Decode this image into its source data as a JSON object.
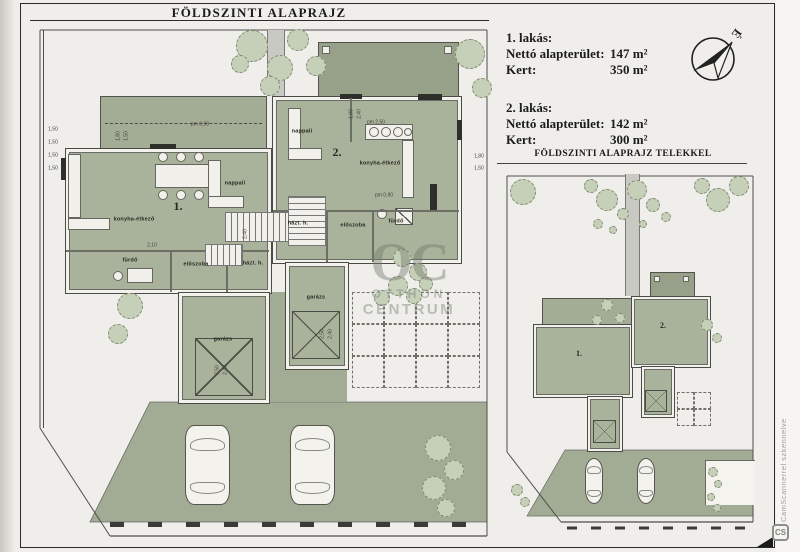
{
  "titles": {
    "main": "FÖLDSZINTI ALAPRAJZ",
    "site": "FÖLDSZINTI ALAPRAJZ TELEKKEL"
  },
  "info": {
    "apartments": [
      {
        "name": "1. lakás:",
        "rows": [
          [
            "Nettó alapterület:",
            "147 m²"
          ],
          [
            "Kert:",
            "350 m²"
          ]
        ]
      },
      {
        "name": "2. lakás:",
        "rows": [
          [
            "Nettó alapterület:",
            "142 m²"
          ],
          [
            "Kert:",
            "300 m²"
          ]
        ]
      }
    ]
  },
  "compass": {
    "north_label": "É"
  },
  "watermarks": {
    "oc_logo": "OC",
    "oc_line1": "OTTHON",
    "oc_line2": "CENTRUM",
    "scanner_text": "CamScannerrel szkennelve",
    "scanner_logo": "CS"
  },
  "colors": {
    "room_green": "#a9b29a",
    "terrace_gray": "#97a189",
    "tree_fill": "#c6cfb8",
    "paper": "#efeeea",
    "frame_line": "#2b2b28"
  },
  "floor_plan": {
    "labels": [
      {
        "text": "1.",
        "x": 148,
        "y": 182,
        "cls": "unit"
      },
      {
        "text": "2.",
        "x": 307,
        "y": 128,
        "cls": "unit"
      },
      {
        "text": "nappali",
        "x": 205,
        "y": 160,
        "cls": "room"
      },
      {
        "text": "konyha-étkező",
        "x": 104,
        "y": 196,
        "cls": "room"
      },
      {
        "text": "fürdő",
        "x": 100,
        "y": 237,
        "cls": "room"
      },
      {
        "text": "előszoba",
        "x": 166,
        "y": 241,
        "cls": "room"
      },
      {
        "text": "házt. h.",
        "x": 223,
        "y": 240,
        "cls": "room"
      },
      {
        "text": "garázs",
        "x": 193,
        "y": 316,
        "cls": "room"
      },
      {
        "text": "nappali",
        "x": 272,
        "y": 108,
        "cls": "room"
      },
      {
        "text": "konyha-étkező",
        "x": 350,
        "y": 140,
        "cls": "room"
      },
      {
        "text": "házt. h.",
        "x": 268,
        "y": 200,
        "cls": "room"
      },
      {
        "text": "előszoba",
        "x": 323,
        "y": 202,
        "cls": "room"
      },
      {
        "text": "fürdő",
        "x": 366,
        "y": 198,
        "cls": "room"
      },
      {
        "text": "garázs",
        "x": 286,
        "y": 274,
        "cls": "room"
      },
      {
        "text": "1,50",
        "x": 23,
        "y": 106,
        "cls": "dim"
      },
      {
        "text": "1,50",
        "x": 23,
        "y": 119,
        "cls": "dim"
      },
      {
        "text": "1,50",
        "x": 23,
        "y": 132,
        "cls": "dim"
      },
      {
        "text": "1,50",
        "x": 23,
        "y": 145,
        "cls": "dim"
      },
      {
        "text": "1,80",
        "x": 89,
        "y": 112,
        "cls": "dim",
        "rot": -90
      },
      {
        "text": "1,50",
        "x": 97,
        "y": 112,
        "cls": "dim",
        "rot": -90
      },
      {
        "text": "pm 0,90",
        "x": 170,
        "y": 101,
        "cls": "dim"
      },
      {
        "text": "pm 2,50",
        "x": 346,
        "y": 99,
        "cls": "dim"
      },
      {
        "text": "1,80",
        "x": 322,
        "y": 90,
        "cls": "dim",
        "rot": -90
      },
      {
        "text": "2,40",
        "x": 330,
        "y": 90,
        "cls": "dim",
        "rot": -90
      },
      {
        "text": "1,80",
        "x": 449,
        "y": 133,
        "cls": "dim"
      },
      {
        "text": "1,50",
        "x": 449,
        "y": 145,
        "cls": "dim"
      },
      {
        "text": "2,10",
        "x": 122,
        "y": 222,
        "cls": "dim"
      },
      {
        "text": "2,40",
        "x": 216,
        "y": 210,
        "cls": "dim",
        "rot": -90
      },
      {
        "text": "pm 0,90",
        "x": 354,
        "y": 172,
        "cls": "dim"
      },
      {
        "text": "2,50",
        "x": 293,
        "y": 310,
        "cls": "dim",
        "rot": -90
      },
      {
        "text": "2,40",
        "x": 301,
        "y": 310,
        "cls": "dim",
        "rot": -90
      },
      {
        "text": "2,50",
        "x": 188,
        "y": 346,
        "cls": "dim",
        "rot": -90
      },
      {
        "text": "2,40",
        "x": 196,
        "y": 346,
        "cls": "dim",
        "rot": -90
      }
    ],
    "trees": [
      {
        "x": 222,
        "y": 22,
        "r": 16
      },
      {
        "x": 250,
        "y": 44,
        "r": 13
      },
      {
        "x": 268,
        "y": 16,
        "r": 11
      },
      {
        "x": 286,
        "y": 42,
        "r": 10
      },
      {
        "x": 240,
        "y": 62,
        "r": 10
      },
      {
        "x": 210,
        "y": 40,
        "r": 9
      },
      {
        "x": 440,
        "y": 30,
        "r": 15
      },
      {
        "x": 452,
        "y": 64,
        "r": 10
      },
      {
        "x": 100,
        "y": 282,
        "r": 13
      },
      {
        "x": 88,
        "y": 310,
        "r": 10
      },
      {
        "x": 372,
        "y": 234,
        "r": 9
      },
      {
        "x": 388,
        "y": 248,
        "r": 9
      },
      {
        "x": 368,
        "y": 262,
        "r": 10
      },
      {
        "x": 352,
        "y": 274,
        "r": 8
      },
      {
        "x": 384,
        "y": 272,
        "r": 8
      },
      {
        "x": 396,
        "y": 260,
        "r": 7
      },
      {
        "x": 408,
        "y": 424,
        "r": 13
      },
      {
        "x": 424,
        "y": 446,
        "r": 10
      },
      {
        "x": 404,
        "y": 464,
        "r": 12
      },
      {
        "x": 416,
        "y": 484,
        "r": 9
      }
    ],
    "paving": [
      {
        "x": 322,
        "y": 268,
        "cols": 4,
        "rows": 3,
        "cell": 32
      }
    ],
    "furniture": [
      {
        "t": "rect",
        "x": 292,
        "y": 22,
        "w": 8,
        "h": 8
      },
      {
        "t": "rect",
        "x": 414,
        "y": 22,
        "w": 8,
        "h": 8
      },
      {
        "t": "rect",
        "x": 125,
        "y": 140,
        "w": 58,
        "h": 24
      },
      {
        "t": "circ",
        "x": 133,
        "y": 133,
        "r": 5
      },
      {
        "t": "circ",
        "x": 151,
        "y": 133,
        "r": 5
      },
      {
        "t": "circ",
        "x": 169,
        "y": 133,
        "r": 5
      },
      {
        "t": "circ",
        "x": 133,
        "y": 171,
        "r": 5
      },
      {
        "t": "circ",
        "x": 151,
        "y": 171,
        "r": 5
      },
      {
        "t": "circ",
        "x": 169,
        "y": 171,
        "r": 5
      },
      {
        "t": "rect",
        "x": 38,
        "y": 130,
        "w": 13,
        "h": 64
      },
      {
        "t": "rect",
        "x": 38,
        "y": 194,
        "w": 42,
        "h": 12
      },
      {
        "t": "rect",
        "x": 178,
        "y": 136,
        "w": 13,
        "h": 44
      },
      {
        "t": "rect",
        "x": 178,
        "y": 172,
        "w": 36,
        "h": 12
      },
      {
        "t": "rect",
        "x": 258,
        "y": 84,
        "w": 13,
        "h": 44
      },
      {
        "t": "rect",
        "x": 258,
        "y": 124,
        "w": 34,
        "h": 12
      },
      {
        "t": "rect",
        "x": 335,
        "y": 100,
        "w": 48,
        "h": 16
      },
      {
        "t": "circ",
        "x": 344,
        "y": 108,
        "r": 5
      },
      {
        "t": "circ",
        "x": 356,
        "y": 108,
        "r": 5
      },
      {
        "t": "circ",
        "x": 368,
        "y": 108,
        "r": 5
      },
      {
        "t": "circ",
        "x": 378,
        "y": 108,
        "r": 4
      },
      {
        "t": "rect",
        "x": 372,
        "y": 116,
        "w": 12,
        "h": 58
      },
      {
        "t": "rect",
        "x": 97,
        "y": 244,
        "w": 26,
        "h": 15
      },
      {
        "t": "circ",
        "x": 88,
        "y": 252,
        "r": 5
      },
      {
        "t": "diag",
        "x": 365,
        "y": 184,
        "w": 18,
        "h": 17
      },
      {
        "t": "circ",
        "x": 352,
        "y": 190,
        "r": 5
      },
      {
        "t": "dark",
        "x": 388,
        "y": 70,
        "w": 24,
        "h": 6
      },
      {
        "t": "dark",
        "x": 31,
        "y": 134,
        "w": 5,
        "h": 22
      },
      {
        "t": "dark",
        "x": 427,
        "y": 96,
        "w": 5,
        "h": 20
      },
      {
        "t": "dark",
        "x": 120,
        "y": 120,
        "w": 26,
        "h": 5
      },
      {
        "t": "dark",
        "x": 310,
        "y": 70,
        "w": 22,
        "h": 5
      },
      {
        "t": "dark",
        "x": 400,
        "y": 160,
        "w": 7,
        "h": 28
      },
      {
        "t": "wall",
        "x": 36,
        "y": 226,
        "w": 203,
        "h": 2
      },
      {
        "t": "wall",
        "x": 140,
        "y": 226,
        "w": 2,
        "h": 42
      },
      {
        "t": "wall",
        "x": 196,
        "y": 226,
        "w": 2,
        "h": 42
      },
      {
        "t": "wall",
        "x": 243,
        "y": 186,
        "w": 186,
        "h": 2
      },
      {
        "t": "wall",
        "x": 296,
        "y": 186,
        "w": 2,
        "h": 52
      },
      {
        "t": "wall",
        "x": 342,
        "y": 186,
        "w": 2,
        "h": 52
      },
      {
        "t": "wall",
        "x": 320,
        "y": 74,
        "w": 2,
        "h": 44
      },
      {
        "t": "stairsH",
        "x": 195,
        "y": 188,
        "w": 64,
        "h": 30
      },
      {
        "t": "stairsH",
        "x": 175,
        "y": 220,
        "w": 38,
        "h": 22
      },
      {
        "t": "stairsV",
        "x": 258,
        "y": 172,
        "w": 38,
        "h": 50
      },
      {
        "t": "xbox",
        "x": 165,
        "y": 314,
        "w": 58,
        "h": 58
      },
      {
        "t": "xbox",
        "x": 262,
        "y": 287,
        "w": 48,
        "h": 48
      },
      {
        "t": "car",
        "x": 155,
        "y": 401,
        "w": 45,
        "h": 80
      },
      {
        "t": "car",
        "x": 260,
        "y": 401,
        "w": 45,
        "h": 80
      }
    ]
  },
  "site_plan": {
    "labels": [
      {
        "text": "1.",
        "x": 76,
        "y": 182,
        "cls": "unit-mini"
      },
      {
        "text": "2.",
        "x": 160,
        "y": 154,
        "cls": "unit-mini"
      }
    ],
    "trees": [
      {
        "x": 20,
        "y": 20,
        "r": 13
      },
      {
        "x": 88,
        "y": 14,
        "r": 7
      },
      {
        "x": 104,
        "y": 28,
        "r": 11
      },
      {
        "x": 120,
        "y": 42,
        "r": 6
      },
      {
        "x": 134,
        "y": 18,
        "r": 10
      },
      {
        "x": 150,
        "y": 33,
        "r": 7
      },
      {
        "x": 163,
        "y": 45,
        "r": 5
      },
      {
        "x": 199,
        "y": 14,
        "r": 8
      },
      {
        "x": 215,
        "y": 28,
        "r": 12
      },
      {
        "x": 236,
        "y": 14,
        "r": 10
      },
      {
        "x": 95,
        "y": 52,
        "r": 5
      },
      {
        "x": 110,
        "y": 58,
        "r": 4
      },
      {
        "x": 140,
        "y": 52,
        "r": 4
      },
      {
        "x": 104,
        "y": 133,
        "r": 6
      },
      {
        "x": 117,
        "y": 146,
        "r": 5
      },
      {
        "x": 94,
        "y": 148,
        "r": 5
      },
      {
        "x": 204,
        "y": 153,
        "r": 6
      },
      {
        "x": 214,
        "y": 166,
        "r": 5
      },
      {
        "x": 14,
        "y": 318,
        "r": 6
      },
      {
        "x": 22,
        "y": 330,
        "r": 5
      },
      {
        "x": 210,
        "y": 300,
        "r": 5
      },
      {
        "x": 215,
        "y": 312,
        "r": 4
      },
      {
        "x": 208,
        "y": 325,
        "r": 4
      },
      {
        "x": 214,
        "y": 336,
        "r": 4
      }
    ],
    "paving": [
      {
        "x": 174,
        "y": 220,
        "cols": 2,
        "rows": 2,
        "cell": 17
      }
    ],
    "furniture": [
      {
        "t": "rect",
        "x": 151,
        "y": 104,
        "w": 6,
        "h": 6
      },
      {
        "t": "rect",
        "x": 180,
        "y": 104,
        "w": 6,
        "h": 6
      },
      {
        "t": "xbox",
        "x": 90,
        "y": 248,
        "w": 23,
        "h": 23
      },
      {
        "t": "xbox",
        "x": 142,
        "y": 218,
        "w": 22,
        "h": 22
      },
      {
        "t": "car",
        "x": 82,
        "y": 286,
        "w": 18,
        "h": 46
      },
      {
        "t": "car",
        "x": 134,
        "y": 286,
        "w": 18,
        "h": 46
      }
    ]
  }
}
